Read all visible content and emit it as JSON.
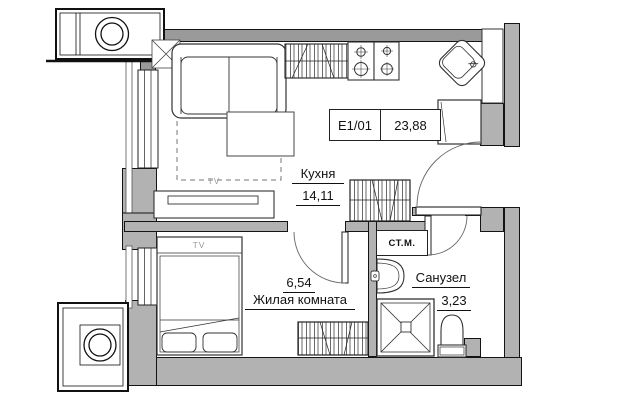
{
  "plan": {
    "unit_box": {
      "code": "E1/01",
      "area": "23,88"
    },
    "rooms": {
      "kitchen": {
        "name": "Кухня",
        "area": "14,11"
      },
      "living": {
        "name": "Жилая комната",
        "area": "6,54"
      },
      "bathroom": {
        "name": "Санузел",
        "area": "3,23"
      }
    },
    "appliances": {
      "washing_machine": "СТ.М.",
      "tv": "TV"
    },
    "colors": {
      "wall_fill": "#b2b2b2",
      "line": "#1a1a1a",
      "muted_text": "#9a9a9a"
    }
  }
}
